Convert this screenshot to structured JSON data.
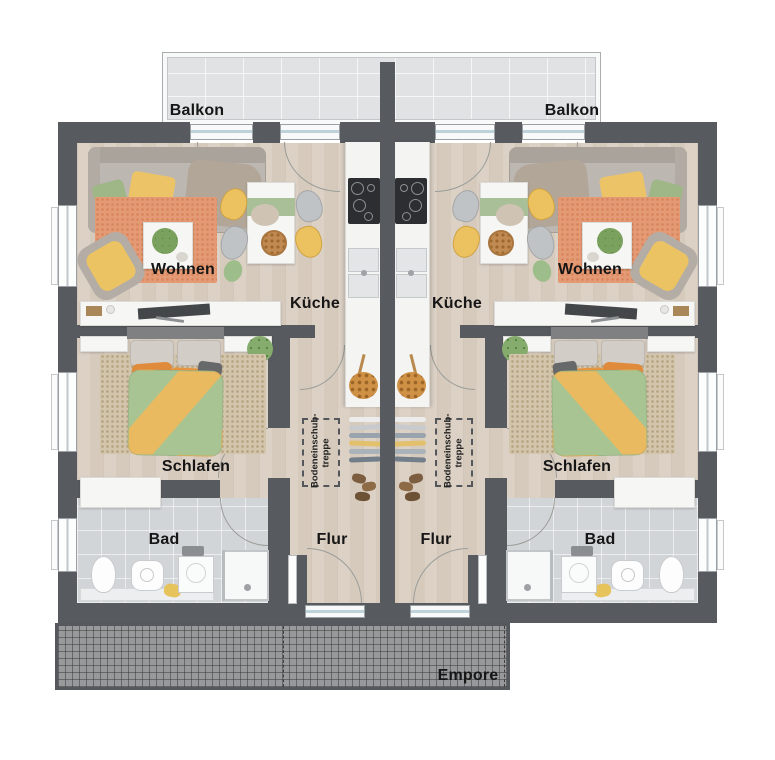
{
  "floor_plan": {
    "labels": {
      "balkon": "Balkon",
      "wohnen": "Wohnen",
      "kueche": "Küche",
      "schlafen": "Schlafen",
      "bad": "Bad",
      "flur": "Flur",
      "empore": "Empore",
      "loft_ladder_line1": "Bodeneinschub-",
      "loft_ladder_line2": "treppe"
    },
    "colors": {
      "wall": "#575b5f",
      "wood_floor": "#dacec1",
      "bathroom_tile": "#d2d5d8",
      "balcony_tile": "#e0e2e3",
      "empore_grid": "#98999b",
      "living_rug": "#e49a74",
      "bedroom_rug": "#d2c5ab",
      "duvet_green": "#a8c492",
      "duvet_yellow": "#e9ba60",
      "accent_yellow": "#ecc160",
      "accent_orange": "#e08a3c",
      "label_text": "#161616"
    }
  }
}
